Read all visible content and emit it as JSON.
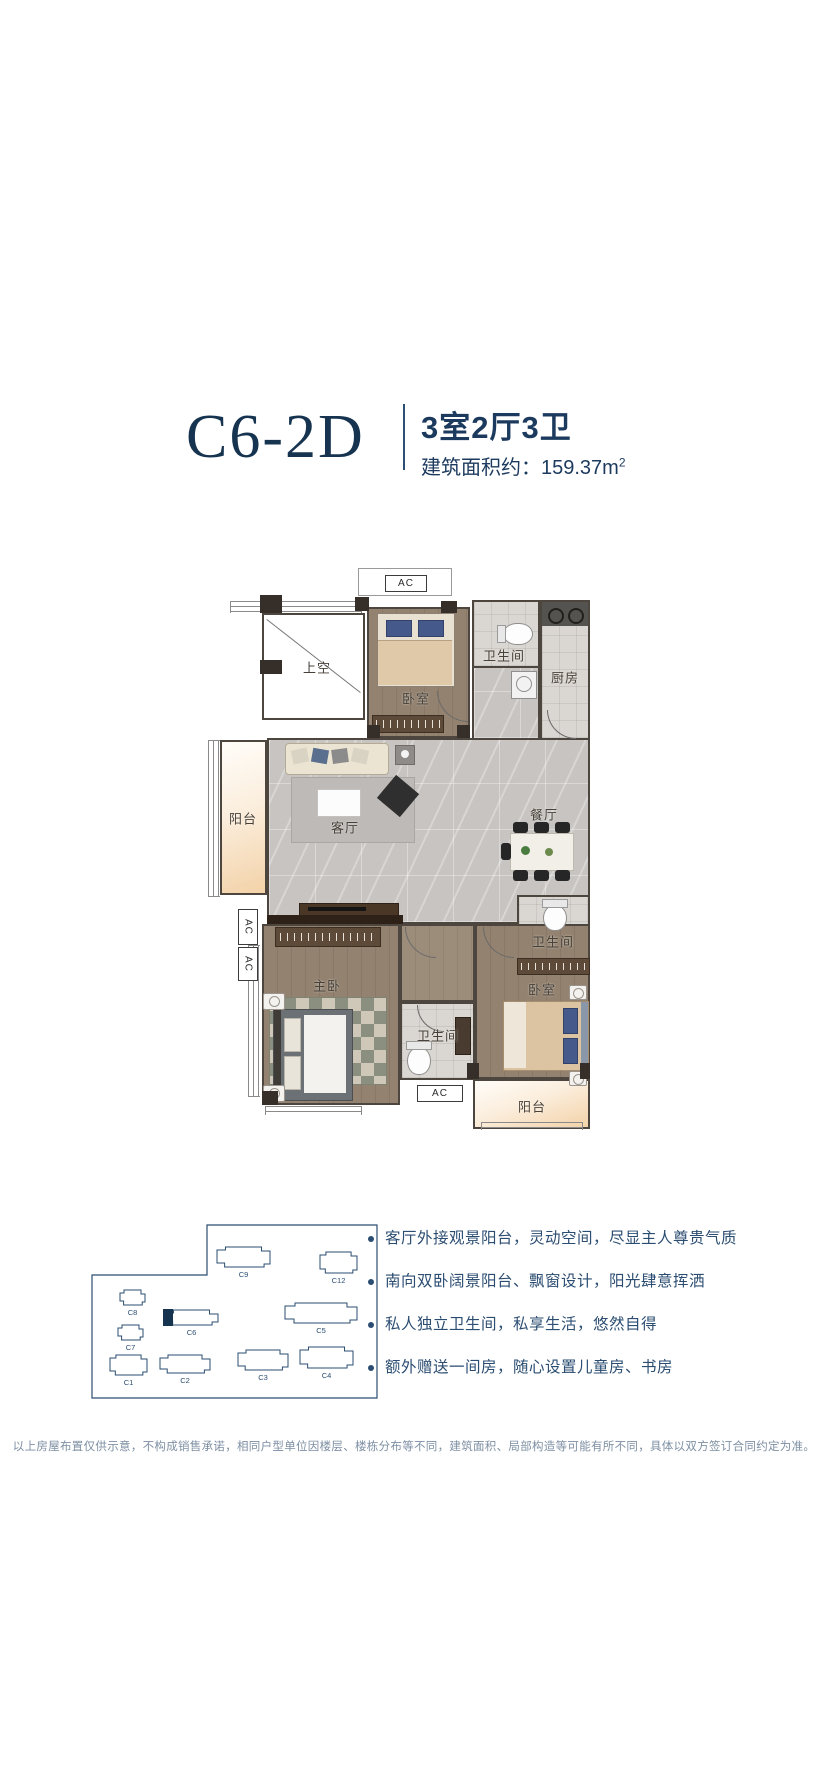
{
  "header": {
    "title": "C6-2D",
    "specs": "3室2厅3卫",
    "area_label": "建筑面积约：",
    "area_value": "159.37",
    "area_unit": "m",
    "area_sup": "2"
  },
  "floorplan": {
    "shangkong": "上空",
    "bedroom_top": "卧室",
    "bath_top": "卫生间",
    "kitchen": "厨房",
    "balcony_left": "阳台",
    "living": "客厅",
    "dining": "餐厅",
    "master": "主卧",
    "bath_bottom": "卫生间",
    "bath_right": "卫生间",
    "bedroom_right": "卧室",
    "balcony_bottom": "阳台",
    "ac": "AC"
  },
  "siteplan": {
    "boundary_path": "M117 3 H287 V176 H2 V53 H117 Z",
    "highlight_id": "C6",
    "buildings": [
      {
        "id": "C9",
        "x": 127,
        "y": 25,
        "w": 53,
        "h": 20
      },
      {
        "id": "C12",
        "x": 230,
        "y": 30,
        "w": 37,
        "h": 21
      },
      {
        "id": "C8",
        "x": 30,
        "y": 68,
        "w": 25,
        "h": 15
      },
      {
        "id": "C6",
        "x": 75,
        "y": 88,
        "w": 53,
        "h": 15
      },
      {
        "id": "C5",
        "x": 195,
        "y": 81,
        "w": 72,
        "h": 20
      },
      {
        "id": "C7",
        "x": 28,
        "y": 103,
        "w": 25,
        "h": 15
      },
      {
        "id": "C1",
        "x": 20,
        "y": 133,
        "w": 37,
        "h": 20
      },
      {
        "id": "C2",
        "x": 70,
        "y": 133,
        "w": 50,
        "h": 18
      },
      {
        "id": "C3",
        "x": 148,
        "y": 128,
        "w": 50,
        "h": 20
      },
      {
        "id": "C4",
        "x": 210,
        "y": 125,
        "w": 53,
        "h": 21
      }
    ]
  },
  "features": [
    "客厅外接观景阳台，灵动空间，尽显主人尊贵气质",
    "南向双卧阔景阳台、飘窗设计，阳光肆意挥洒",
    "私人独立卫生间，私享生活，悠然自得",
    "额外赠送一间房，随心设置儿童房、书房"
  ],
  "disclaimer": "以上房屋布置仅供示意，不构成销售承诺，相同户型单位因楼层、楼栋分布等不同，建筑面积、局部构造等可能有所不同，具体以双方签订合同约定为准。",
  "colors": {
    "accent_navy": "#16334f",
    "text_navy": "#2b4d72",
    "room_label": "#474139",
    "disclaimer_gray": "#7d8fa3",
    "balcony_orange": "#f3d2a8",
    "wood_floor": "#93826f",
    "tile_floor": "#dad6d1",
    "marble_floor": "#c7c4c1",
    "wall_dark": "#362f29"
  }
}
